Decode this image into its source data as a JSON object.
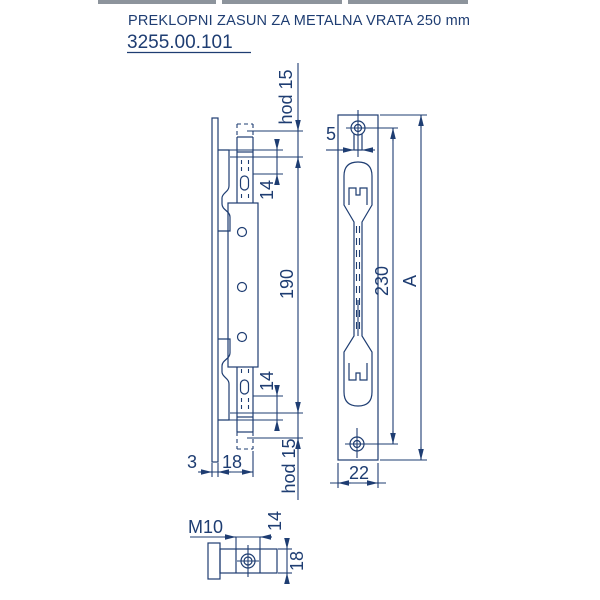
{
  "title": {
    "line1": "PREKLOPNI ZASUN ZA METALNA VRATA 250 mm",
    "code": "3255.00.101"
  },
  "colors": {
    "line": "#1e3d72",
    "background": "#ffffff",
    "top_strip": "#8d949c"
  },
  "side_view": {
    "dim_hod15_top": "hod 15",
    "dim_14_top": "14",
    "dim_190": "190",
    "dim_14_bottom": "14",
    "dim_hod15_bottom": "hod 15",
    "dim_3": "3",
    "dim_18": "18"
  },
  "front_view": {
    "dim_5": "5",
    "dim_230": "230",
    "dim_A": "A",
    "dim_22": "22"
  },
  "detail_view": {
    "thread_label": "M10",
    "dim_14": "14",
    "dim_18": "18"
  }
}
